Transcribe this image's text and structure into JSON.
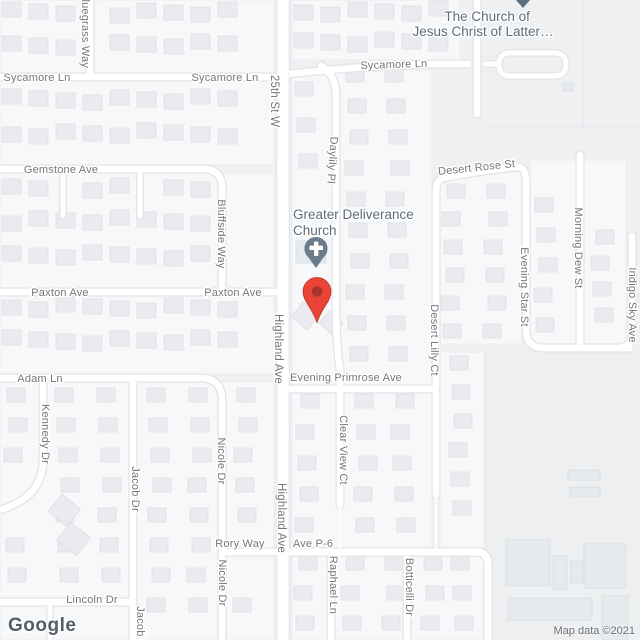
{
  "colors": {
    "background": "#eef0f2",
    "block_fill": "#f7f8f9",
    "open_area_fill": "#edeff1",
    "house_fill": "#e9ebee",
    "house_stroke": "#dcdfe3",
    "road_fill": "#ffffff",
    "road_casing": "#e2e5e9",
    "road_label": "#73777c",
    "poi_label": "#5f6c78",
    "destination_pin": "#e94436",
    "destination_pin_inner": "#a8352b",
    "church_pin": "#6b7d8c",
    "offscreen_pin_tip": "#5b6c7e"
  },
  "watermark": {
    "logo": "Google",
    "attribution": "Map data ©2021"
  },
  "pois": {
    "lds_church": {
      "line1": "The Church of",
      "line2": "Jesus Christ of Latter…"
    },
    "greater_deliverance": {
      "line1": "Greater Deliverance",
      "line2": "Church"
    }
  },
  "markers": {
    "destination": "red location pin",
    "church": "church pin with cross",
    "offscreen_top": "cut-off pin tail"
  },
  "roads": {
    "labels": [
      {
        "id": "sycamore-ln-1",
        "text": "Sycamore Ln"
      },
      {
        "id": "sycamore-ln-2",
        "text": "Sycamore Ln"
      },
      {
        "id": "sycamore-ln-3",
        "text": "Sycamore Ln"
      },
      {
        "id": "bluegrass-way",
        "text": "Bluegrass Way"
      },
      {
        "id": "25th-st-w",
        "text": "25th St W"
      },
      {
        "id": "daylily-pl",
        "text": "Daylily Pl"
      },
      {
        "id": "gemstone-ave",
        "text": "Gemstone Ave"
      },
      {
        "id": "bluffside-way",
        "text": "Bluffside Way"
      },
      {
        "id": "desert-rose-st",
        "text": "Desert Rose St"
      },
      {
        "id": "paxton-ave-1",
        "text": "Paxton Ave"
      },
      {
        "id": "paxton-ave-2",
        "text": "Paxton Ave"
      },
      {
        "id": "desert-lilly-ct",
        "text": "Desert Lilly Ct"
      },
      {
        "id": "evening-star-st",
        "text": "Evening Star St"
      },
      {
        "id": "morning-dew-st",
        "text": "Morning Dew St"
      },
      {
        "id": "indigo-sky-ave",
        "text": "Indigo Sky Ave"
      },
      {
        "id": "highland-ave-1",
        "text": "Highland Ave"
      },
      {
        "id": "highland-ave-2",
        "text": "Highland Ave"
      },
      {
        "id": "adam-ln",
        "text": "Adam Ln"
      },
      {
        "id": "kennedy-dr",
        "text": "Kennedy Dr"
      },
      {
        "id": "evening-primrose-ave",
        "text": "Evening Primrose Ave"
      },
      {
        "id": "clear-view-ct",
        "text": "Clear View Ct"
      },
      {
        "id": "nicole-dr-1",
        "text": "Nicole Dr"
      },
      {
        "id": "nicole-dr-2",
        "text": "Nicole Dr"
      },
      {
        "id": "jacob-dr-1",
        "text": "Jacob Dr"
      },
      {
        "id": "jacob-dr-2",
        "text": "Jacob Dr"
      },
      {
        "id": "rory-way",
        "text": "Rory Way"
      },
      {
        "id": "ave-p-6",
        "text": "Ave P-6"
      },
      {
        "id": "lincoln-dr",
        "text": "Lincoln Dr"
      },
      {
        "id": "raphael-ln",
        "text": "Raphael Ln"
      },
      {
        "id": "botticelli-dr",
        "text": "Botticelli Dr"
      }
    ]
  }
}
